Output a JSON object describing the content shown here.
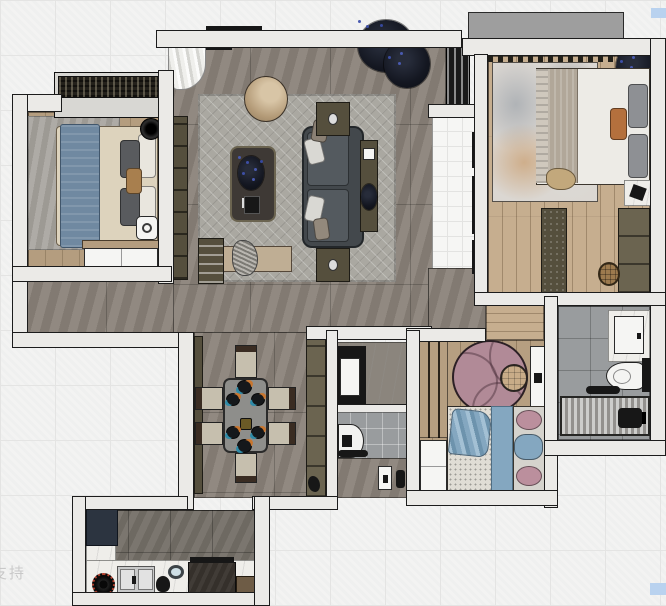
{
  "watermarks": {
    "bottom_left_text": "支持",
    "swatch_color": "#b9d2ef"
  },
  "colors": {
    "bg": "#f3f3f2",
    "bgLine": "#e4e4e3",
    "wall": "#ebeae7",
    "wallLine": "#1c1c1c",
    "floorGrey": "#8a8279",
    "rugLiving": "#aaa8a1",
    "woodMaster": "#c6ae8f",
    "woodKids": "#b69f81",
    "woodBed1": "#b49d7f",
    "foyerTile": "#f6f6f4",
    "bathTile": "#999c9e",
    "kitchenFloor": "#746f67",
    "marble": "#efeeea",
    "sofa": "#43484c",
    "sofaCushion": "#545a5f",
    "pillowLight": "#d9d8d3",
    "tableDark": "#3e3935",
    "olive": "#554f3d",
    "olive2": "#6b6450",
    "armchair": "#c2ab8b",
    "bench": "#bfae94",
    "bedBlue": "#7089a1",
    "duvet": "#ddd3bd",
    "pillowGrey": "#595b5e",
    "masterDuvet": "#edebe6",
    "masterBlanket": "#b1a799",
    "pillowSlate": "#8e9094",
    "pillowOrange": "#b4703d",
    "rugMasterBase": "#dbd7d2",
    "kidsRug": "#b18a97",
    "kidsPouf": "#c8ac88",
    "kidsBlanket": "#84a7c0",
    "kidsPillow": "#bb8f9d",
    "mattress": "#e0ddd5",
    "white": "#f5f5f3",
    "black": "#171717",
    "fridge": "#2c3440",
    "steel": "#c8c9c9",
    "brownCab": "#6e5c46",
    "diningChair": "#c6bfae",
    "chairBack": "#3a2c22",
    "tableGrey": "#8e8e8b",
    "accentOrange": "#c8762f",
    "accentTeal": "#2f8ba8",
    "balcony": "#9e9e9e",
    "watermarkColor": "#c2c2c2",
    "blueSwatch": "#b9d2ef"
  }
}
